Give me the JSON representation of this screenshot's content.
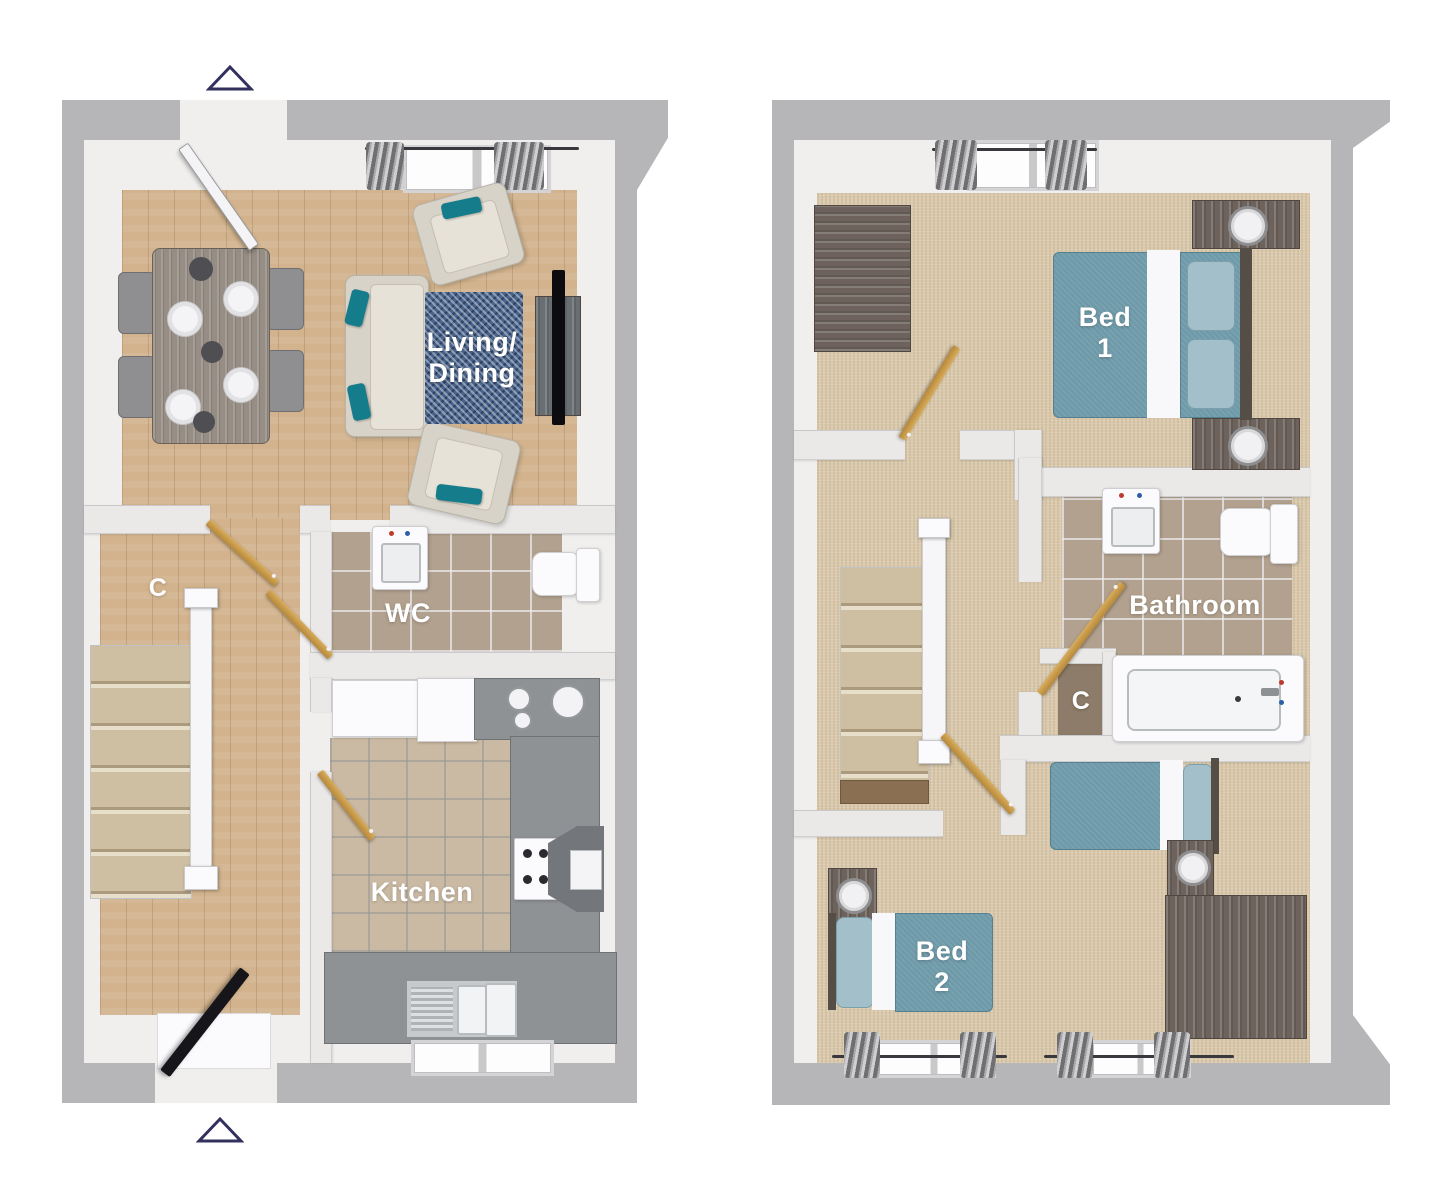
{
  "title": "Two-storey house floor plan",
  "markers": {
    "top": "triangle-up",
    "bottom": "triangle-up"
  },
  "ground": {
    "name": "Ground floor",
    "labels": {
      "living1": "Living/",
      "living2": "Dining",
      "wc": "WC",
      "kitchen": "Kitchen",
      "cupboard": "C"
    },
    "features": [
      "front-door",
      "dining-table",
      "dining-chairs",
      "place-settings",
      "sofa",
      "armchairs",
      "area-rug",
      "tv-unit",
      "living-window",
      "wc-sink",
      "wc-toilet",
      "internal-doors",
      "staircase",
      "under-stair-cupboard",
      "kitchen-counters",
      "appliances",
      "hob-extractor",
      "kitchen-sink",
      "kitchen-window",
      "rear-door",
      "door-mat"
    ]
  },
  "first": {
    "name": "First floor",
    "labels": {
      "bed1a": "Bed",
      "bed1b": "1",
      "bathroom": "Bathroom",
      "cupboard": "C",
      "bed2a": "Bed",
      "bed2b": "2"
    },
    "features": [
      "double-bed",
      "nightstands",
      "lamps",
      "wardrobe",
      "bedroom1-window",
      "landing",
      "staircase",
      "bathroom-sink",
      "bathroom-toilet",
      "bathtub",
      "airing-cupboard",
      "single-beds",
      "chest-of-drawers",
      "bedroom2-windows"
    ]
  },
  "colors": {
    "outer_wall": "#b6b6b8",
    "inner_wall": "#f0efed",
    "wood_floor": "#d2b38d",
    "carpet": "#dbcaad",
    "bathroom_tile": "#b2a18e",
    "kitchen_tile": "#cbbaa3",
    "counter_gray": "#8f9295",
    "rug_blue": "#49648c",
    "bed_teal": "#6d99a8",
    "accent_teal": "#157c8c",
    "internal_door_wood": "#c89c4a",
    "dark_furniture": "#6d635c",
    "marker_outline": "#32315e",
    "label_text": "#ffffff"
  }
}
